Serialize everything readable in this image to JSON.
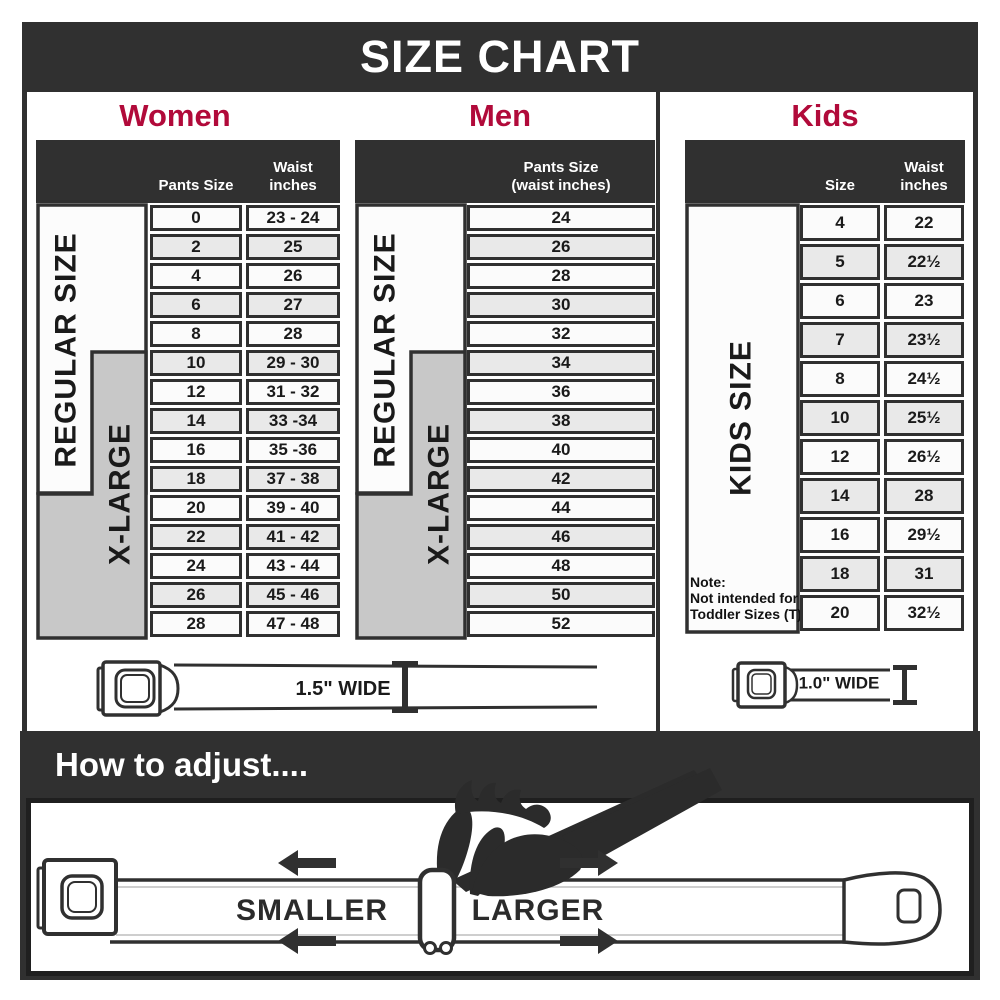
{
  "title": "SIZE CHART",
  "palette": {
    "dark": "#303030",
    "red": "#b10a3a",
    "gray_fill": "#c8c8c8"
  },
  "women": {
    "heading": "Women",
    "header": {
      "pants": "Pants Size",
      "waist_line1": "Waist",
      "waist_line2": "inches"
    },
    "regular_label": "REGULAR SIZE",
    "xlarge_label": "X-LARGE",
    "rows": [
      {
        "size": "0",
        "waist": "23 - 24"
      },
      {
        "size": "2",
        "waist": "25"
      },
      {
        "size": "4",
        "waist": "26"
      },
      {
        "size": "6",
        "waist": "27"
      },
      {
        "size": "8",
        "waist": "28"
      },
      {
        "size": "10",
        "waist": "29 - 30"
      },
      {
        "size": "12",
        "waist": "31 - 32"
      },
      {
        "size": "14",
        "waist": "33 -34"
      },
      {
        "size": "16",
        "waist": "35 -36"
      },
      {
        "size": "18",
        "waist": "37 - 38"
      },
      {
        "size": "20",
        "waist": "39 - 40"
      },
      {
        "size": "22",
        "waist": "41 - 42"
      },
      {
        "size": "24",
        "waist": "43 - 44"
      },
      {
        "size": "26",
        "waist": "45 - 46"
      },
      {
        "size": "28",
        "waist": "47 - 48"
      }
    ]
  },
  "men": {
    "heading": "Men",
    "header": {
      "line1": "Pants Size",
      "line2": "(waist inches)"
    },
    "regular_label": "REGULAR SIZE",
    "xlarge_label": "X-LARGE",
    "rows": [
      "24",
      "26",
      "28",
      "30",
      "32",
      "34",
      "36",
      "38",
      "40",
      "42",
      "44",
      "46",
      "48",
      "50",
      "52"
    ]
  },
  "kids": {
    "heading": "Kids",
    "header": {
      "size": "Size",
      "waist_line1": "Waist",
      "waist_line2": "inches"
    },
    "label": "KIDS SIZE",
    "note": {
      "line1": "Note:",
      "line2": "Not intended for",
      "line3": "Toddler Sizes (T)"
    },
    "rows": [
      {
        "size": "4",
        "waist": "22"
      },
      {
        "size": "5",
        "waist": "22½"
      },
      {
        "size": "6",
        "waist": "23"
      },
      {
        "size": "7",
        "waist": "23½"
      },
      {
        "size": "8",
        "waist": "24½"
      },
      {
        "size": "10",
        "waist": "25½"
      },
      {
        "size": "12",
        "waist": "26½"
      },
      {
        "size": "14",
        "waist": "28"
      },
      {
        "size": "16",
        "waist": "29½"
      },
      {
        "size": "18",
        "waist": "31"
      },
      {
        "size": "20",
        "waist": "32½"
      }
    ]
  },
  "belts": {
    "adult_width_label": "1.5\" WIDE",
    "kids_width_label": "1.0\" WIDE"
  },
  "how_to_adjust": {
    "heading": "How to adjust....",
    "smaller": "SMALLER",
    "larger": "LARGER"
  }
}
